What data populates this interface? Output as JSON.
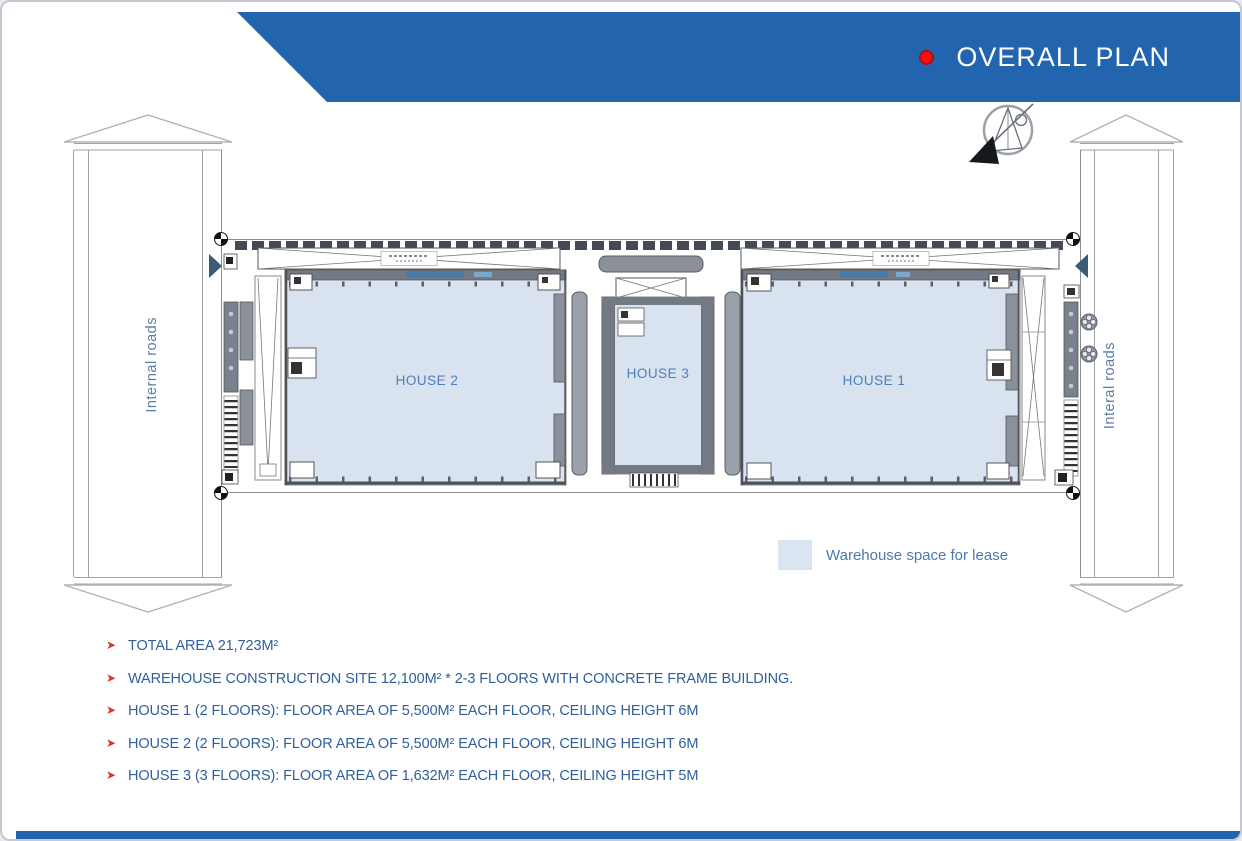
{
  "slide": {
    "title": "OVERALL PLAN"
  },
  "plan": {
    "left_road_label": "Internal roads",
    "right_road_label": "Interal roads",
    "houses": [
      {
        "id": "house-2",
        "label": "HOUSE 2"
      },
      {
        "id": "house-3",
        "label": "HOUSE 3"
      },
      {
        "id": "house-1",
        "label": "HOUSE 1"
      }
    ],
    "legend": {
      "label": "Warehouse space for lease",
      "swatch_color": "#dbe5f1"
    }
  },
  "notes": {
    "marker": "➤",
    "items": [
      "TOTAL AREA 21,723M²",
      "WAREHOUSE CONSTRUCTION SITE 12,100M² * 2-3 FLOORS WITH CONCRETE FRAME BUILDING.",
      "HOUSE 1 (2 FLOORS): FLOOR AREA OF 5,500M² EACH FLOOR, CEILING HEIGHT 6M",
      "HOUSE 2 (2 FLOORS): FLOOR AREA OF 5,500M² EACH FLOOR, CEILING HEIGHT 6M",
      "HOUSE 3 (3 FLOORS): FLOOR AREA OF 1,632M² EACH FLOOR, CEILING HEIGHT 5M"
    ]
  },
  "icons": {
    "title_bullet": "red-dot",
    "compass": "north-arrow",
    "note_marker": "arrow-bullet"
  },
  "colors": {
    "banner_blue": "#2264ad",
    "title_dot_red": "#ff0c0c",
    "warehouse_fill": "#d9e2ef",
    "wall_gray": "#737a85",
    "note_text_blue": "#30609a",
    "marker_red": "#d6382c",
    "road_label_blue": "#5d7ca6"
  }
}
